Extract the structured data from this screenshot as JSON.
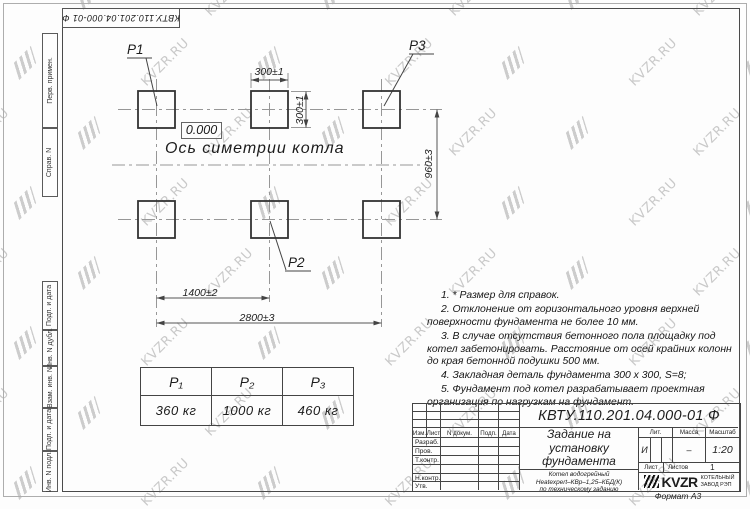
{
  "watermark": {
    "text": "KVZR.RU"
  },
  "top_stamp": {
    "doc_number": "КВТУ.110.201.04.000-01  Ф"
  },
  "margin_labels": [
    "Перв. примен.",
    "Справ. N",
    "Подп. и дата",
    "Инв. N дубл.",
    "Взам. инв. N",
    "Подп. и дата",
    "Инв. N подл."
  ],
  "drawing": {
    "labels": {
      "p1": "P1",
      "p2": "P2",
      "p3": "P3"
    },
    "level_mark": "0.000",
    "axis_label": "Ось симетрии котла",
    "dimensions": {
      "plate_width": "300±1",
      "plate_height": "300±1",
      "row_spacing": "960±3",
      "col_spacing": "1400±2",
      "total_span": "2800±3"
    }
  },
  "load_table": {
    "headers": [
      "P₁",
      "P₂",
      "P₃"
    ],
    "values": [
      "360  кг",
      "1000  кг",
      "460  кг"
    ]
  },
  "notes": [
    "1.  * Размер для справок.",
    "2.  Отклонение от горизонтального уровня верхней поверхности фундамента не более 10 мм.",
    "3.  В случае отсутствия бетонного пола площадку под котел забетонировать. Расстояние от осей крайних колонн до края бетонной подушки 500 мм.",
    "4.  Закладная деталь фундамента  300 x 300,  S=8;",
    "5.  Фундамент под котел разрабатывает проектная организация по нагрузкам на фундамент."
  ],
  "title_block": {
    "doc_number": "КВТУ.110.201.04.000-01  Ф",
    "doc_title": "Задание на установку фундамента",
    "product": [
      "Котел водогрейный",
      "Heatexpert–КВр–1,25–КБД(К)",
      "по техническому заданию"
    ],
    "columns": [
      "Изм.",
      "Лист",
      "N докум.",
      "Подп.",
      "Дата"
    ],
    "rows": [
      "Разраб.",
      "Пров.",
      "Т.контр.",
      "",
      "Н.контр.",
      "Утв."
    ],
    "lit_label": "Лит.",
    "lit_value": "И",
    "massa_label": "Масса",
    "massa_value": "–",
    "scale_label": "Масштаб",
    "scale_value": "1:20",
    "sheet_label": "Лист",
    "sheets_label": "Листов",
    "sheets_value": "1",
    "company": {
      "logo": "KVZR",
      "name1": "КОТЕЛЬНЫЙ",
      "name2": "ЗАВОД РЭП"
    }
  },
  "format_label": "Формат А3"
}
